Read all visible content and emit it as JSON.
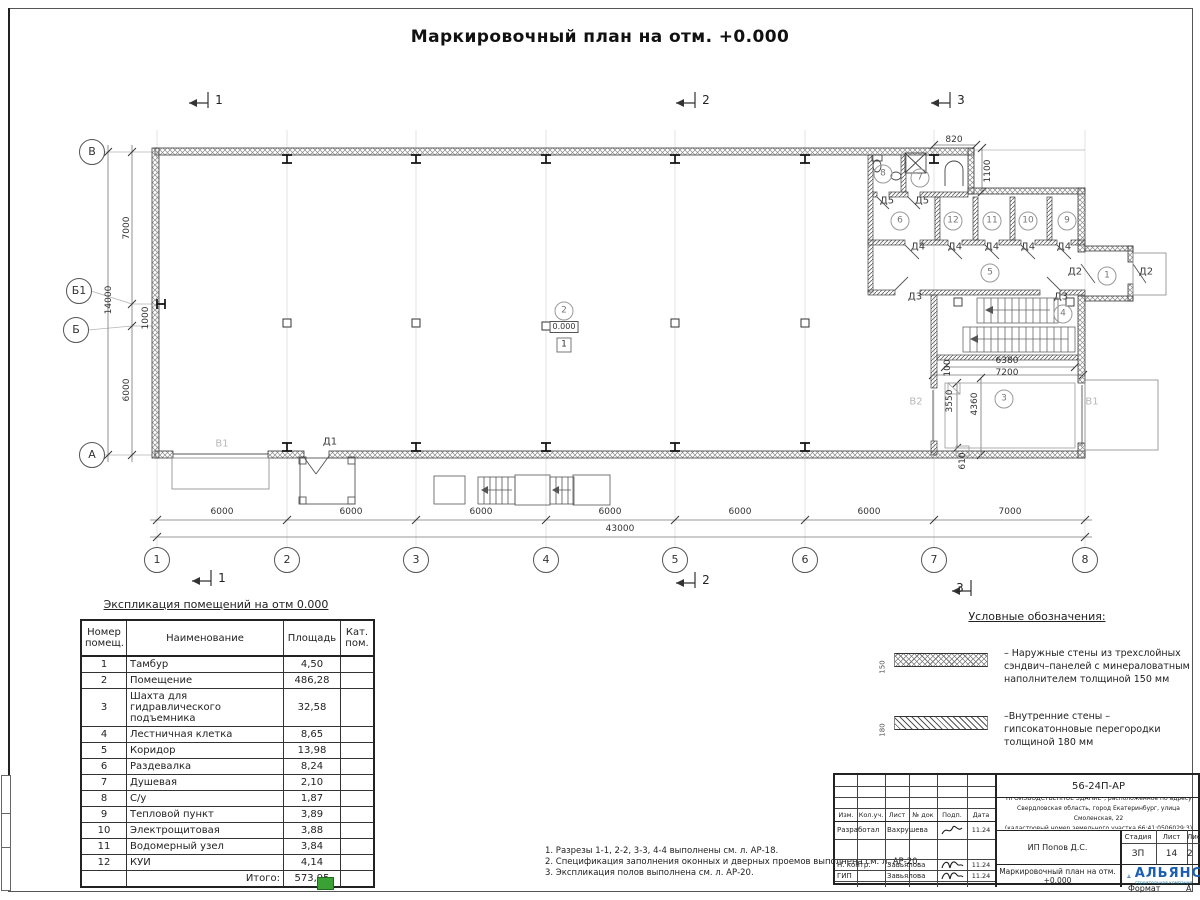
{
  "sheet": {
    "title": "Маркировочный план на отм. +0.000",
    "format_label": "Формат",
    "format_value": "А"
  },
  "plan": {
    "axes": [
      {
        "t": "1",
        "x": 157,
        "y": 560
      },
      {
        "t": "2",
        "x": 287,
        "y": 560
      },
      {
        "t": "3",
        "x": 416,
        "y": 560
      },
      {
        "t": "4",
        "x": 546,
        "y": 560
      },
      {
        "t": "5",
        "x": 675,
        "y": 560
      },
      {
        "t": "6",
        "x": 805,
        "y": 560
      },
      {
        "t": "7",
        "x": 934,
        "y": 560
      },
      {
        "t": "8",
        "x": 1085,
        "y": 560
      },
      {
        "t": "В",
        "x": 92,
        "y": 152
      },
      {
        "t": "Б1",
        "x": 79,
        "y": 291
      },
      {
        "t": "Б",
        "x": 76,
        "y": 330
      },
      {
        "t": "А",
        "x": 92,
        "y": 455
      }
    ],
    "rooms": [
      {
        "t": "1",
        "x": 1107,
        "y": 276
      },
      {
        "t": "2",
        "x": 564,
        "y": 311
      },
      {
        "t": "3",
        "x": 1004,
        "y": 399
      },
      {
        "t": "4",
        "x": 1063,
        "y": 314
      },
      {
        "t": "5",
        "x": 990,
        "y": 273
      },
      {
        "t": "6",
        "x": 900,
        "y": 221
      },
      {
        "t": "7",
        "x": 920,
        "y": 178
      },
      {
        "t": "8",
        "x": 883,
        "y": 174
      },
      {
        "t": "9",
        "x": 1067,
        "y": 221
      },
      {
        "t": "10",
        "x": 1028,
        "y": 221
      },
      {
        "t": "11",
        "x": 992,
        "y": 221
      },
      {
        "t": "12",
        "x": 953,
        "y": 221
      }
    ],
    "labels": [
      {
        "k": "dim",
        "t": "6000",
        "x": 222,
        "y": 512
      },
      {
        "k": "dim",
        "t": "6000",
        "x": 351,
        "y": 512
      },
      {
        "k": "dim",
        "t": "6000",
        "x": 481,
        "y": 512
      },
      {
        "k": "dim",
        "t": "6000",
        "x": 610,
        "y": 512
      },
      {
        "k": "dim",
        "t": "6000",
        "x": 740,
        "y": 512
      },
      {
        "k": "dim",
        "t": "6000",
        "x": 869,
        "y": 512
      },
      {
        "k": "dim",
        "t": "7000",
        "x": 1010,
        "y": 512
      },
      {
        "k": "dim",
        "t": "43000",
        "x": 620,
        "y": 529
      },
      {
        "k": "dimv",
        "t": "7000",
        "x": 127,
        "y": 228
      },
      {
        "k": "dimv",
        "t": "14000",
        "x": 109,
        "y": 300
      },
      {
        "k": "dimv",
        "t": "1000",
        "x": 146,
        "y": 318
      },
      {
        "k": "dimv",
        "t": "6000",
        "x": 127,
        "y": 390
      },
      {
        "k": "dim",
        "t": "820",
        "x": 954,
        "y": 140
      },
      {
        "k": "dimv",
        "t": "1100",
        "x": 988,
        "y": 171
      },
      {
        "k": "dim",
        "t": "6380",
        "x": 1007,
        "y": 361
      },
      {
        "k": "dim",
        "t": "7200",
        "x": 1007,
        "y": 373
      },
      {
        "k": "dimv",
        "t": "100",
        "x": 948,
        "y": 368
      },
      {
        "k": "dimv",
        "t": "3550",
        "x": 950,
        "y": 401
      },
      {
        "k": "dimv",
        "t": "4360",
        "x": 975,
        "y": 404
      },
      {
        "k": "dimv",
        "t": "610",
        "x": 963,
        "y": 461
      },
      {
        "k": "door",
        "t": "Д5",
        "x": 887,
        "y": 201
      },
      {
        "k": "door",
        "t": "Д5",
        "x": 922,
        "y": 201
      },
      {
        "k": "door",
        "t": "Д4",
        "x": 918,
        "y": 247
      },
      {
        "k": "door",
        "t": "Д4",
        "x": 955,
        "y": 247
      },
      {
        "k": "door",
        "t": "Д4",
        "x": 992,
        "y": 247
      },
      {
        "k": "door",
        "t": "Д4",
        "x": 1028,
        "y": 247
      },
      {
        "k": "door",
        "t": "Д4",
        "x": 1064,
        "y": 247
      },
      {
        "k": "door",
        "t": "Д3",
        "x": 915,
        "y": 297
      },
      {
        "k": "door",
        "t": "Д3",
        "x": 1061,
        "y": 297
      },
      {
        "k": "door",
        "t": "Д2",
        "x": 1075,
        "y": 272
      },
      {
        "k": "door",
        "t": "Д2",
        "x": 1146,
        "y": 272
      },
      {
        "k": "door",
        "t": "Д1",
        "x": 330,
        "y": 442
      },
      {
        "k": "gate",
        "t": "В1",
        "x": 222,
        "y": 444
      },
      {
        "k": "gate",
        "t": "В2",
        "x": 916,
        "y": 402
      },
      {
        "k": "gate",
        "t": "В1",
        "x": 1092,
        "y": 402
      },
      {
        "k": "sec",
        "t": "1",
        "x": 219,
        "y": 100
      },
      {
        "k": "sec",
        "t": "2",
        "x": 706,
        "y": 100
      },
      {
        "k": "sec",
        "t": "3",
        "x": 961,
        "y": 100
      },
      {
        "k": "sec",
        "t": "1",
        "x": 222,
        "y": 578
      },
      {
        "k": "sec",
        "t": "2",
        "x": 706,
        "y": 580
      },
      {
        "k": "sec",
        "t": "3",
        "x": 960,
        "y": 588
      },
      {
        "k": "elev",
        "t": "0.000",
        "x": 564,
        "y": 327
      },
      {
        "k": "fbox",
        "t": "1",
        "x": 564,
        "y": 345
      }
    ]
  },
  "table": {
    "title": "Экспликация помещений на отм 0.000",
    "headers": [
      "Номер помещ.",
      "Наименование",
      "Площадь",
      "Кат. пом."
    ],
    "rows": [
      {
        "num": "1",
        "name": "Тамбур",
        "area": "4,50"
      },
      {
        "num": "2",
        "name": "Помещение",
        "area": "486,28"
      },
      {
        "num": "3",
        "name": "Шахта для гидравлического подъемника",
        "area": "32,58"
      },
      {
        "num": "4",
        "name": "Лестничная клетка",
        "area": "8,65"
      },
      {
        "num": "5",
        "name": "Коридор",
        "area": "13,98"
      },
      {
        "num": "6",
        "name": "Раздевалка",
        "area": "8,24"
      },
      {
        "num": "7",
        "name": "Душевая",
        "area": "2,10"
      },
      {
        "num": "8",
        "name": "С/у",
        "area": "1,87"
      },
      {
        "num": "9",
        "name": "Тепловой пункт",
        "area": "3,89"
      },
      {
        "num": "10",
        "name": "Электрощитовая",
        "area": "3,88"
      },
      {
        "num": "11",
        "name": "Водомерный узел",
        "area": "3,84"
      },
      {
        "num": "12",
        "name": "КУИ",
        "area": "4,14"
      }
    ],
    "total_label": "Итого:",
    "total": "573,95"
  },
  "legend": {
    "title": "Условные обозначения:",
    "items": [
      {
        "dim": "150",
        "lines": [
          "– Наружные стены из трехслойных",
          "сэндвич–панелей с минераловатным",
          "наполнителем толщиной 150 мм"
        ]
      },
      {
        "dim": "180",
        "lines": [
          "–Внутренние стены –",
          "гипсокатонновые перегородки",
          "толщиной 180 мм"
        ]
      }
    ]
  },
  "notes": [
    "1. Разрезы 1-1, 2-2, 3-3, 4-4 выполнены см. л. АР-18.",
    "2. Спецификация заполнения оконных и дверных проемов выполнена см. л. АР-20.",
    "3. Экспликация полов выполнена см. л. АР-20."
  ],
  "titleblock": {
    "code": "56-24П-АР",
    "desc": [
      "\"ПРОИЗВОДСТВЕННОЕ ЗДАНИЕ\", расположенное по адресу:",
      "Свердловская область, город Екатеринбург, улица Смоленская, 22",
      "(кадастровый номер земельного участка 66:41:0506029:3)"
    ],
    "cols": [
      "Изм.",
      "Кол.уч.",
      "Лист",
      "№ док",
      "Подп.",
      "Дата"
    ],
    "sign_rows": [
      {
        "role": "Разработал",
        "name": "Вахрушева",
        "date": "11.24"
      },
      {
        "role": "Н. контр.",
        "name": "Завьялова",
        "date": "11.24"
      },
      {
        "role": "ГИП",
        "name": "Завьялова",
        "date": "11.24"
      }
    ],
    "org": "ИП Попов Д.С.",
    "doc_title": "Маркировочный план на отм. +0.000",
    "stage_label": "Стадия",
    "sheet_label": "Лист",
    "sheets_label": "Листов",
    "stage": "ЗП",
    "sheet_num": "14",
    "sheets_num": "2",
    "logo_name": "АЛЬЯНС",
    "logo_sub": "строительная компания"
  }
}
